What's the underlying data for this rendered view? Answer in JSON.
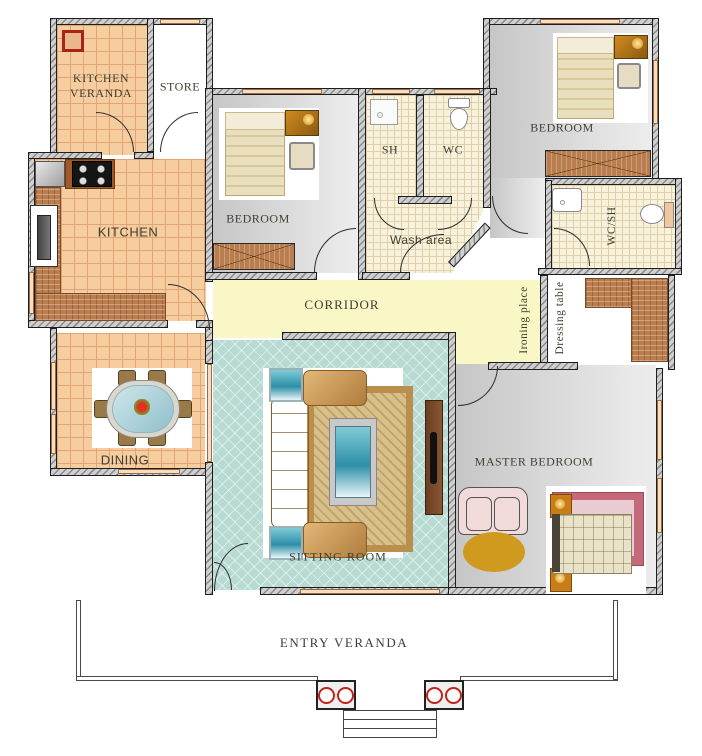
{
  "title": "House floor plan",
  "rooms": {
    "kitchen_veranda": {
      "label": "KITCHEN VERANDA"
    },
    "store": {
      "label": "STORE"
    },
    "kitchen": {
      "label": "KITCHEN"
    },
    "bedroom_center": {
      "label": "BEDROOM"
    },
    "shower": {
      "label": "SH"
    },
    "wc": {
      "label": "WC"
    },
    "wash_area": {
      "label": "Wash area"
    },
    "bedroom_right": {
      "label": "BEDROOM"
    },
    "wc_sh": {
      "label": "WC/SH"
    },
    "corridor": {
      "label": "CORRIDOR"
    },
    "ironing_place": {
      "label": "Ironing place"
    },
    "dressing_table": {
      "label": "Dressing table"
    },
    "dining": {
      "label": "DINING"
    },
    "sitting_room": {
      "label": "SITTING ROOM"
    },
    "master_bedroom": {
      "label": "MASTER BEDROOM"
    },
    "entry_veranda": {
      "label": "ENTRY  VERANDA"
    }
  },
  "colors": {
    "tile_orange": "#f6cd9f",
    "tile_grid": "#e2a476",
    "bath_cream": "#f8f2dd",
    "corridor_yellow": "#f9f7c5",
    "sitting_teal": "#b7dad3",
    "room_gray": "#d5d5d5",
    "counter_brick": "#b97d4e",
    "wall_fill": "#d0d0d0",
    "window_fill": "#f6ddc0",
    "label_text": "#3e3e32",
    "accent_red": "#c0241c",
    "sofa_gold": "#c89a5a",
    "ottoman_gold": "#cf9a1d",
    "rug_rose": "#c4697a",
    "loveseat_pink": "#f0dada"
  },
  "icons": [
    "floor-drain-icon",
    "sink-icon",
    "stove-icon",
    "fridge-icon",
    "bed-icon",
    "wardrobe-icon",
    "shower-tray-icon",
    "toilet-icon",
    "washbasin-icon",
    "dining-table-icon",
    "chair-icon",
    "sofa-icon",
    "armchair-icon",
    "coffee-table-icon",
    "side-table-icon",
    "rug-icon",
    "tv-icon",
    "loveseat-icon",
    "ottoman-icon",
    "nightstand-lamp-icon",
    "pillar-icon",
    "steps-icon"
  ]
}
